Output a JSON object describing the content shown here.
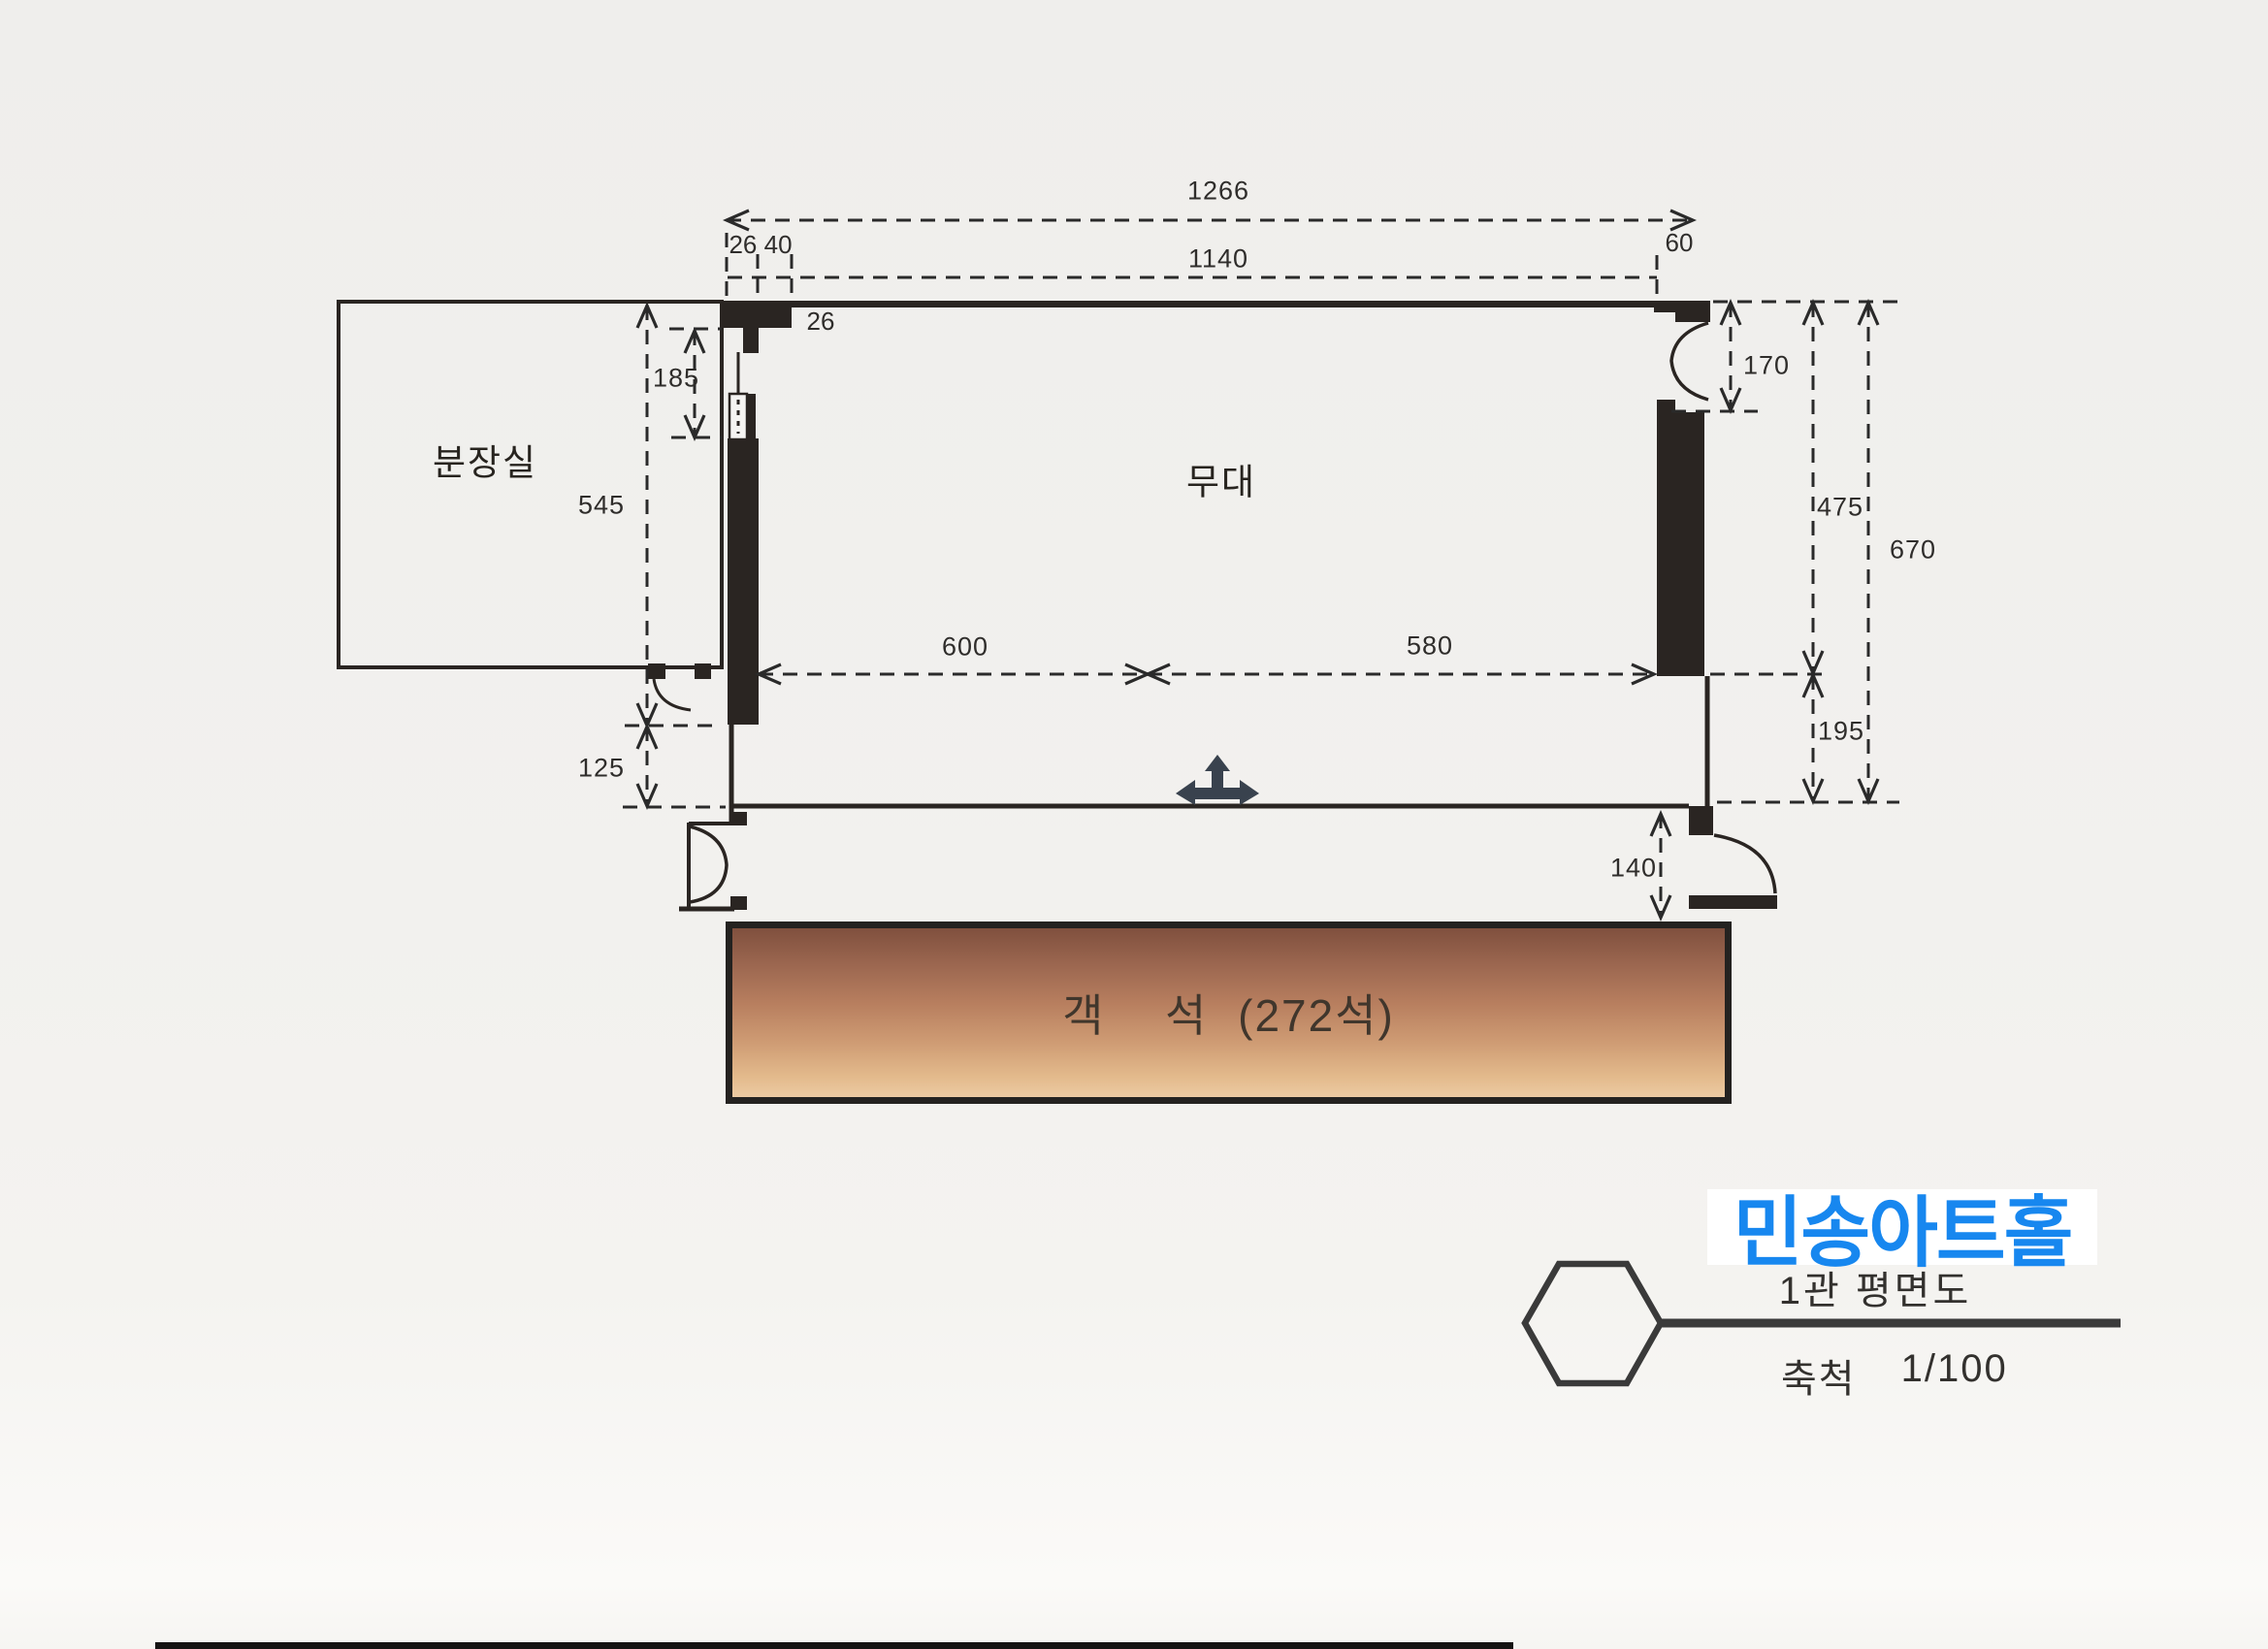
{
  "plan": {
    "rooms": {
      "dressing_room": "분장실",
      "stage": "무대",
      "seating": "객  석 (272석)"
    },
    "dimensions": {
      "top_overall": "1266",
      "top_inner": "1140",
      "top_left_pair": "26 40",
      "top_right": "60",
      "wall_thickness": "26",
      "left_door_opening": "185",
      "left_height": "545",
      "right_door_opening": "170",
      "right_stage_depth": "475",
      "right_overall_depth": "670",
      "stage_width_left": "600",
      "stage_width_right": "580",
      "right_apron": "195",
      "left_apron": "125",
      "right_entry": "140"
    }
  },
  "title_block": {
    "hall_name": "민송아트홀",
    "drawing_title": "1관 평면도",
    "scale_label": "축척",
    "scale_value": "1/100"
  },
  "colors": {
    "accent_blue": "#1787ef",
    "wall_ink": "#2a2522",
    "dimension_ink": "#2a2a2a",
    "seat_gradient_top": "#80503e",
    "seat_gradient_bottom": "#eccaa2",
    "paper": "#f1f0ee",
    "stage_arrow": "#39424e"
  },
  "icons": {
    "stage_direction": "three-way-arrow-icon",
    "title_marker": "hexagon-icon"
  }
}
